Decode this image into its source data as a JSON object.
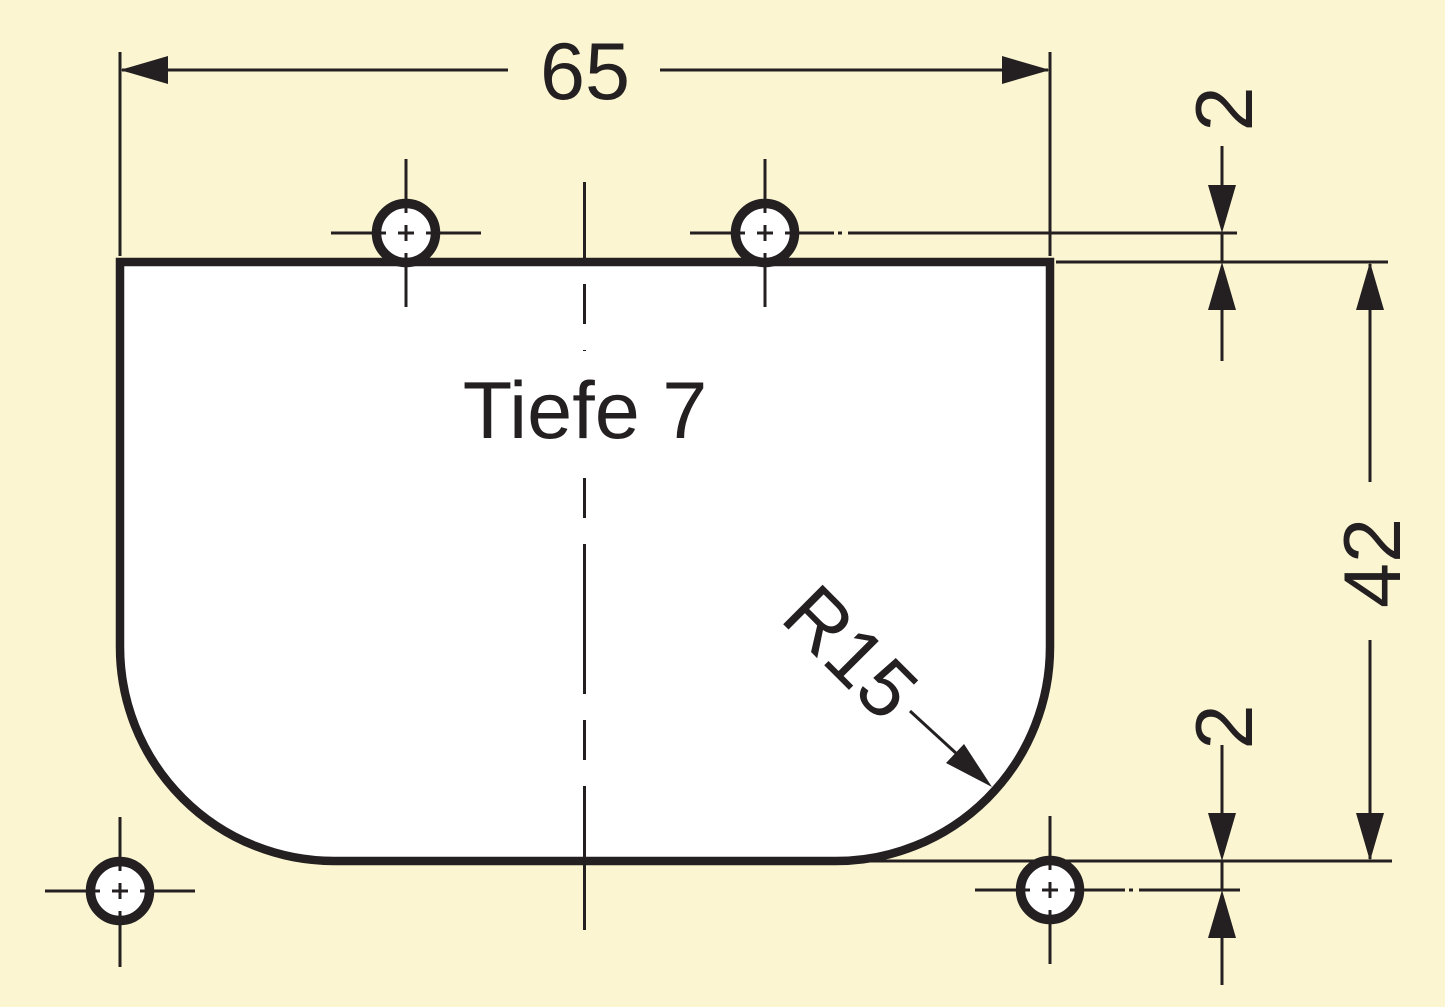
{
  "drawing": {
    "labels": {
      "width": "65",
      "edge_offset_top": "2",
      "height": "42",
      "edge_offset_bottom": "2",
      "depth": "Tiefe 7",
      "corner_radius": "R15"
    },
    "colors": {
      "background": "#FBF6D1",
      "ink": "#242021",
      "part_fill": "#FFFFFF"
    }
  }
}
